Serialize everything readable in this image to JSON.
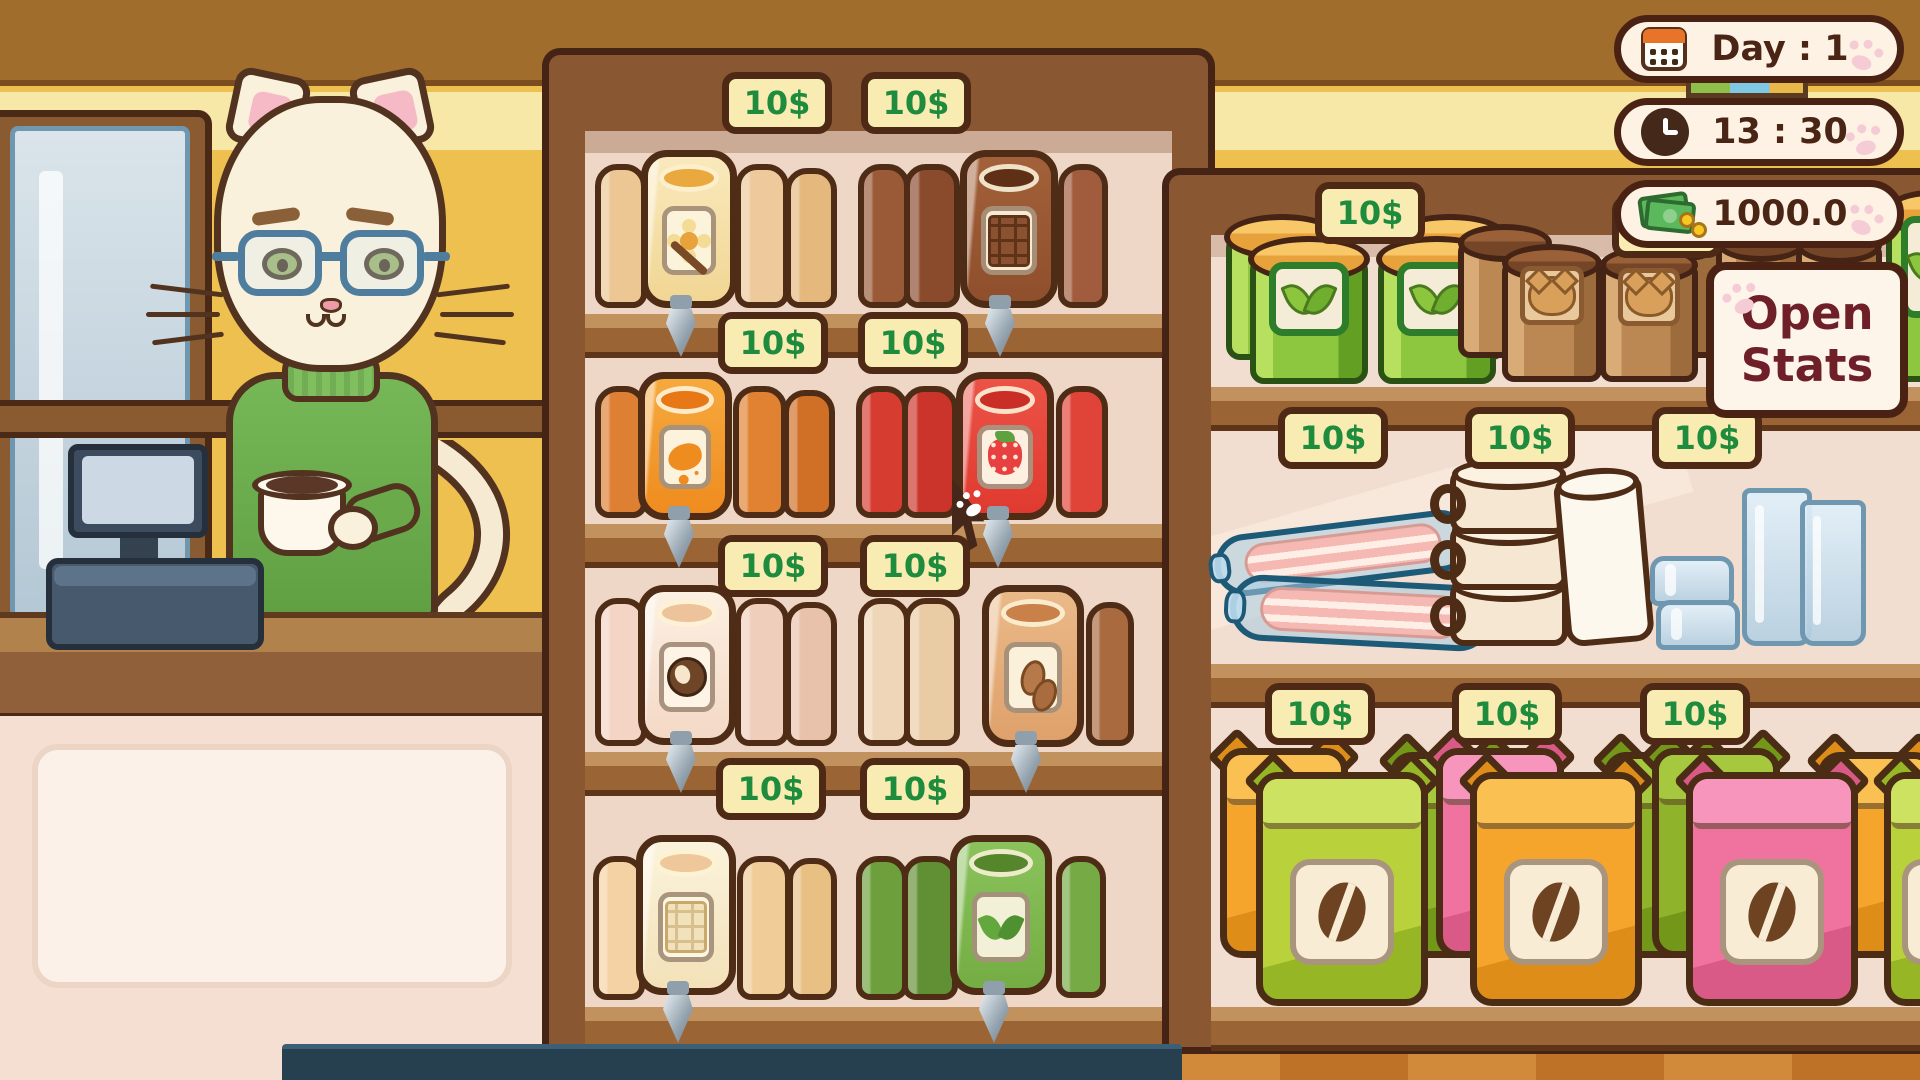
{
  "hud": {
    "day_label": "Day : 1",
    "time_label": "13 : 30",
    "money_label": "1000.0",
    "stats_button": {
      "line1": "Open",
      "line2": "Stats"
    }
  },
  "price_label": "10$",
  "colors": {
    "tag_text": "#1f8b3d",
    "hud_text": "#4a2414",
    "stats_text": "#6e1f28",
    "pill_bg": "#fdf2e3",
    "outline": "#452415",
    "wall": "#edc04f",
    "wall_band": "#a06d2d"
  },
  "scene": {
    "cursor": [
      952,
      478
    ],
    "left_shelf": {
      "name": "syrup-shelf",
      "tags": [
        [
          722,
          72
        ],
        [
          861,
          72
        ],
        [
          718,
          312
        ],
        [
          858,
          312
        ],
        [
          718,
          535
        ],
        [
          860,
          535
        ],
        [
          716,
          758
        ],
        [
          860,
          758
        ]
      ],
      "groups": [
        {
          "name": "vanilla-syrup-dispenser",
          "icon": "vanilla",
          "front": [
            641,
            150,
            96,
            158
          ],
          "c1": "#f9e9bc",
          "c2": "#f1d694",
          "open": "#e9a93e",
          "label": "#fcf4da",
          "backs": [
            [
              595,
              164,
              52,
              144,
              "#ecc794"
            ],
            [
              735,
              164,
              54,
              144,
              "#eec99b"
            ],
            [
              785,
              168,
              52,
              140,
              "#e5b87e"
            ]
          ],
          "tap": [
            663,
            295
          ]
        },
        {
          "name": "chocolate-syrup-dispenser",
          "icon": "chocolate",
          "front": [
            960,
            150,
            98,
            158
          ],
          "c1": "#a3613a",
          "c2": "#8f4f2c",
          "open": "#5f3015",
          "label": "#f6ead2",
          "backs": [
            [
              858,
              164,
              52,
              144,
              "#9a5a38"
            ],
            [
              904,
              164,
              56,
              144,
              "#8a4a2c"
            ],
            [
              1058,
              164,
              50,
              144,
              "#a05c3c"
            ]
          ],
          "tap": [
            982,
            295
          ]
        },
        {
          "name": "caramel-syrup-dispenser",
          "icon": "caramel",
          "front": [
            638,
            372,
            94,
            148
          ],
          "c1": "#f6a93e",
          "c2": "#ef8c1f",
          "open": "#e87715",
          "label": "#fdf3dc",
          "backs": [
            [
              595,
              386,
              52,
              132,
              "#dd8034"
            ],
            [
              733,
              386,
              54,
              132,
              "#e08232"
            ],
            [
              783,
              390,
              52,
              128,
              "#d06f26"
            ]
          ],
          "tap": [
            661,
            506
          ]
        },
        {
          "name": "strawberry-syrup-dispenser",
          "icon": "strawberry",
          "front": [
            956,
            372,
            98,
            148
          ],
          "c1": "#ec5246",
          "c2": "#e03a30",
          "open": "#c92f26",
          "label": "#fdf0e0",
          "backs": [
            [
              856,
              386,
              52,
              132,
              "#d63c30"
            ],
            [
              902,
              386,
              56,
              132,
              "#ca342a"
            ],
            [
              1056,
              386,
              52,
              132,
              "#e04438"
            ]
          ],
          "tap": [
            980,
            506
          ]
        },
        {
          "name": "coconut-syrup-dispenser",
          "icon": "coconut",
          "front": [
            638,
            585,
            98,
            160
          ],
          "c1": "#fcf0e2",
          "c2": "#f4d9c6",
          "open": "#edc39c",
          "label": "#fdf4e6",
          "backs": [
            [
              595,
              598,
              52,
              148,
              "#f4d5c5"
            ],
            [
              735,
              598,
              54,
              148,
              "#f0cebc"
            ],
            [
              785,
              602,
              52,
              144,
              "#e9c2ac"
            ]
          ],
          "tap": [
            663,
            731
          ]
        },
        {
          "name": "almond-syrup-dispenser",
          "icon": "almond",
          "front": [
            982,
            585,
            102,
            162
          ],
          "c1": "#eab988",
          "c2": "#dfa16b",
          "open": "#c98049",
          "label": "#fbf0da",
          "backs": [
            [
              858,
              598,
              52,
              148,
              "#efd6b8"
            ],
            [
              904,
              598,
              56,
              148,
              "#e9cba4"
            ],
            [
              1086,
              602,
              48,
              144,
              "#a96a40"
            ]
          ],
          "tap": [
            1008,
            731
          ]
        },
        {
          "name": "white-chocolate-syrup-dispenser",
          "icon": "whitechoc",
          "front": [
            636,
            835,
            100,
            160
          ],
          "c1": "#fbf3dc",
          "c2": "#f3e1b8",
          "open": "#eec79a",
          "label": "#fdf6e2",
          "backs": [
            [
              593,
              856,
              52,
              144,
              "#f4d2a4"
            ],
            [
              737,
              856,
              54,
              144,
              "#f0cc98"
            ],
            [
              787,
              858,
              50,
              142,
              "#e9c084"
            ]
          ],
          "tap": [
            660,
            981
          ]
        },
        {
          "name": "matcha-syrup-dispenser",
          "icon": "matcha",
          "front": [
            950,
            835,
            102,
            160
          ],
          "c1": "#8ac25c",
          "c2": "#74ad43",
          "open": "#55862c",
          "label": "#f3f0d8",
          "backs": [
            [
              856,
              856,
              52,
              144,
              "#6da03c"
            ],
            [
              902,
              856,
              56,
              144,
              "#618f33"
            ],
            [
              1056,
              856,
              50,
              142,
              "#76aa45"
            ]
          ],
          "tap": [
            976,
            981
          ]
        }
      ]
    },
    "right_shelf": {
      "name": "goods-shelf",
      "tags": [
        [
          1315,
          182
        ],
        [
          1612,
          196
        ],
        [
          1278,
          407
        ],
        [
          1465,
          407
        ],
        [
          1652,
          407
        ],
        [
          1265,
          683
        ],
        [
          1452,
          683
        ],
        [
          1640,
          683
        ]
      ],
      "jars": [
        [
          1226,
          234,
          112,
          126,
          0
        ],
        [
          1394,
          234,
          112,
          126,
          0
        ],
        [
          1250,
          256,
          118,
          128,
          1
        ],
        [
          1378,
          256,
          118,
          128,
          1
        ],
        [
          1886,
          210,
          90,
          172,
          1
        ]
      ],
      "canisters": [
        [
          1458,
          240,
          94,
          118,
          0
        ],
        [
          1630,
          240,
          94,
          118,
          0
        ],
        [
          1716,
          240,
          90,
          116,
          0
        ],
        [
          1796,
          242,
          86,
          114,
          0
        ],
        [
          1502,
          260,
          100,
          122,
          1
        ],
        [
          1600,
          262,
          98,
          120,
          1
        ]
      ],
      "sausages": [
        [
          1214,
          522,
          258,
          62,
          -7
        ],
        [
          1230,
          580,
          262,
          66,
          3
        ]
      ],
      "mugs": [
        [
          1450,
          580,
          118,
          66
        ],
        [
          1450,
          524,
          118,
          66
        ],
        [
          1450,
          468,
          118,
          66
        ]
      ],
      "white_mug": [
        1560,
        478,
        88,
        166,
        -5
      ],
      "glasses_stacked": [
        [
          1650,
          556,
          84,
          50
        ],
        [
          1656,
          600,
          84,
          50
        ]
      ],
      "glasses_tall": [
        [
          1742,
          488,
          70,
          158
        ],
        [
          1800,
          500,
          66,
          146
        ]
      ],
      "bags": [
        {
          "front": [
            1256,
            772,
            172,
            234,
            "lime"
          ],
          "backs": [
            [
              1220,
              748,
              128,
              210,
              "orange"
            ],
            [
              1390,
              752,
              120,
              206,
              "green"
            ]
          ]
        },
        {
          "front": [
            1470,
            772,
            172,
            234,
            "orange"
          ],
          "backs": [
            [
              1436,
              748,
              128,
              210,
              "pink"
            ],
            [
              1604,
              752,
              120,
              206,
              "green"
            ]
          ]
        },
        {
          "front": [
            1686,
            772,
            172,
            234,
            "pink"
          ],
          "backs": [
            [
              1652,
              748,
              128,
              210,
              "green"
            ],
            [
              1818,
              752,
              118,
              206,
              "orange"
            ]
          ]
        },
        {
          "front": [
            1884,
            772,
            140,
            234,
            "lime"
          ],
          "backs": []
        }
      ],
      "bag_colors": {
        "lime": [
          "#cee262",
          "#b9d23b",
          "#96b625"
        ],
        "orange": [
          "#fbc052",
          "#f5a52c",
          "#dd8d18"
        ],
        "pink": [
          "#f795bd",
          "#f0739f",
          "#d95a86"
        ],
        "green": [
          "#a5c83e",
          "#8fb32a",
          "#739718"
        ]
      }
    }
  }
}
